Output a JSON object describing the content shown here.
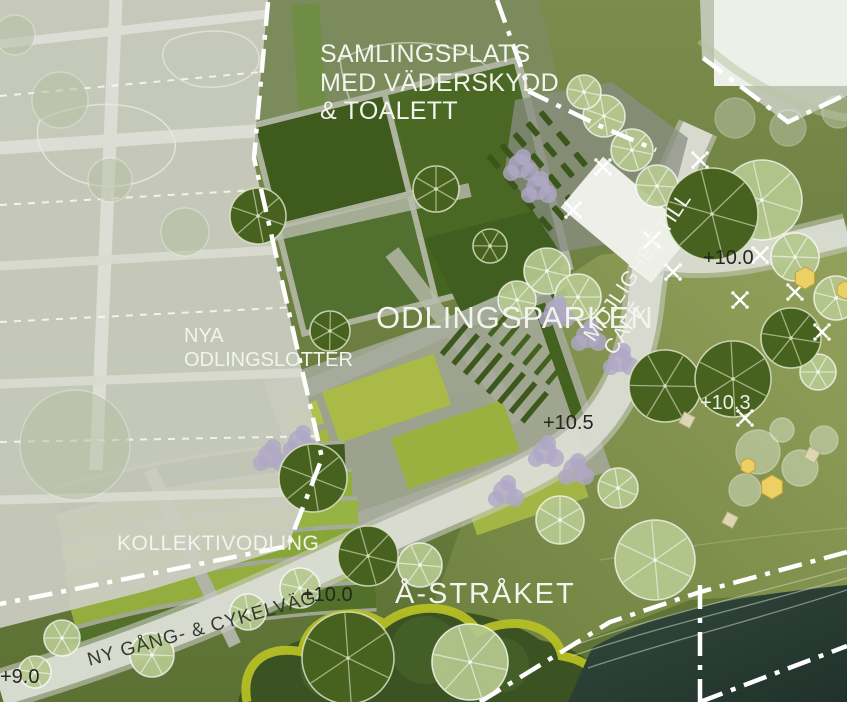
{
  "page": {
    "type": "landscape-architecture-site-plan"
  },
  "palette": {
    "base_lawn": "#6e8040",
    "dark_field": "#3e5a1c",
    "light_bed": "#a9ba47",
    "kollektiv_band": "#8fae3a",
    "path_gray": "#dadcd3",
    "faded_overlay": "#cbcec2",
    "water": "#243830",
    "boundary_white": "#ffffff",
    "tree_dark": "#47611f",
    "tree_light": "#b6c98f",
    "shrub_purple": "#afa7c6",
    "accent_yellow_arc": "#b5bf25",
    "hexagon_yellow": "#ecd064",
    "label_light": "#f2f4ed",
    "label_dark": "#343a30"
  },
  "labels": {
    "samlingsplats": "SAMLINGSPLATS\nMED VÄDERSKYDD\n& TOALETT",
    "mojlighet_cafe": "MÖJLIGHET TILL\nCAFÉ",
    "odlingsparken": "ODLINGSPARKEN",
    "nya_odlingslotter": "NYA\nODLINGSLOTTER",
    "kollektivodling": "KOLLEKTIVODLING",
    "a_straket": "Å-STRÅKET",
    "ny_gang_cykelvag": "NY GÅNG- & CYKELVÄG"
  },
  "elevation_markers": [
    {
      "value": "+10.0",
      "tone": "dark",
      "x": 703,
      "y": 247
    },
    {
      "value": "+10.3",
      "tone": "light",
      "x": 700,
      "y": 392
    },
    {
      "value": "+10.5",
      "tone": "dark",
      "x": 543,
      "y": 412
    },
    {
      "value": "+10.0",
      "tone": "dark",
      "x": 302,
      "y": 584
    },
    {
      "value": "+9.0",
      "tone": "dark",
      "x": 0,
      "y": 666
    }
  ],
  "features": {
    "trees_street": [
      {
        "x": 665,
        "y": 386,
        "r": 36
      },
      {
        "x": 733,
        "y": 379,
        "r": 38
      },
      {
        "x": 791,
        "y": 338,
        "r": 30
      },
      {
        "x": 712,
        "y": 214,
        "r": 46
      },
      {
        "x": 313,
        "y": 478,
        "r": 34
      },
      {
        "x": 368,
        "y": 556,
        "r": 30
      },
      {
        "x": 436,
        "y": 189,
        "r": 23
      },
      {
        "x": 330,
        "y": 331,
        "r": 20
      },
      {
        "x": 490,
        "y": 246,
        "r": 17
      },
      {
        "x": 258,
        "y": 216,
        "r": 28
      },
      {
        "x": 348,
        "y": 658,
        "r": 46
      }
    ],
    "trees_light": [
      {
        "x": 547,
        "y": 271,
        "r": 23
      },
      {
        "x": 578,
        "y": 297,
        "r": 23
      },
      {
        "x": 517,
        "y": 300,
        "r": 19
      },
      {
        "x": 604,
        "y": 116,
        "r": 21
      },
      {
        "x": 632,
        "y": 150,
        "r": 21
      },
      {
        "x": 657,
        "y": 186,
        "r": 21
      },
      {
        "x": 584,
        "y": 92,
        "r": 17
      },
      {
        "x": 762,
        "y": 200,
        "r": 40
      },
      {
        "x": 795,
        "y": 257,
        "r": 24
      },
      {
        "x": 836,
        "y": 298,
        "r": 22
      },
      {
        "x": 818,
        "y": 372,
        "r": 18
      },
      {
        "x": 420,
        "y": 565,
        "r": 22
      },
      {
        "x": 300,
        "y": 588,
        "r": 20
      },
      {
        "x": 248,
        "y": 612,
        "r": 18
      },
      {
        "x": 655,
        "y": 560,
        "r": 40
      },
      {
        "x": 560,
        "y": 520,
        "r": 24
      },
      {
        "x": 618,
        "y": 488,
        "r": 20
      },
      {
        "x": 152,
        "y": 655,
        "r": 22
      },
      {
        "x": 62,
        "y": 638,
        "r": 18
      },
      {
        "x": 35,
        "y": 672,
        "r": 16
      },
      {
        "x": 470,
        "y": 662,
        "r": 38
      }
    ],
    "trees_faded": [
      {
        "x": 60,
        "y": 100,
        "r": 28
      },
      {
        "x": 185,
        "y": 232,
        "r": 24
      },
      {
        "x": 75,
        "y": 445,
        "r": 55
      },
      {
        "x": 15,
        "y": 35,
        "r": 20
      },
      {
        "x": 110,
        "y": 180,
        "r": 22
      },
      {
        "x": 735,
        "y": 118,
        "r": 20
      },
      {
        "x": 788,
        "y": 128,
        "r": 18
      },
      {
        "x": 838,
        "y": 112,
        "r": 16
      }
    ],
    "play_circles": [
      {
        "x": 758,
        "y": 452,
        "r": 22
      },
      {
        "x": 800,
        "y": 468,
        "r": 18
      },
      {
        "x": 824,
        "y": 440,
        "r": 14
      },
      {
        "x": 745,
        "y": 490,
        "r": 16
      },
      {
        "x": 782,
        "y": 430,
        "r": 12
      }
    ],
    "shrubs": [
      {
        "x": 556,
        "y": 312
      },
      {
        "x": 588,
        "y": 336
      },
      {
        "x": 620,
        "y": 360
      },
      {
        "x": 646,
        "y": 382
      },
      {
        "x": 300,
        "y": 442
      },
      {
        "x": 270,
        "y": 456
      },
      {
        "x": 545,
        "y": 452
      },
      {
        "x": 575,
        "y": 470
      },
      {
        "x": 520,
        "y": 166
      },
      {
        "x": 538,
        "y": 188
      },
      {
        "x": 505,
        "y": 492
      }
    ],
    "plant_symbols": [
      {
        "x": 603,
        "y": 167
      },
      {
        "x": 573,
        "y": 210
      },
      {
        "x": 673,
        "y": 272
      },
      {
        "x": 700,
        "y": 160
      },
      {
        "x": 740,
        "y": 300
      },
      {
        "x": 795,
        "y": 292
      },
      {
        "x": 760,
        "y": 255
      },
      {
        "x": 822,
        "y": 332
      },
      {
        "x": 745,
        "y": 418
      },
      {
        "x": 652,
        "y": 240
      }
    ],
    "hexagons": [
      {
        "x": 805,
        "y": 278,
        "r": 11
      },
      {
        "x": 845,
        "y": 290,
        "r": 9
      },
      {
        "x": 772,
        "y": 487,
        "r": 12
      },
      {
        "x": 748,
        "y": 466,
        "r": 8
      }
    ],
    "squares": [
      {
        "x": 687,
        "y": 420
      },
      {
        "x": 730,
        "y": 520
      },
      {
        "x": 812,
        "y": 455
      }
    ]
  }
}
